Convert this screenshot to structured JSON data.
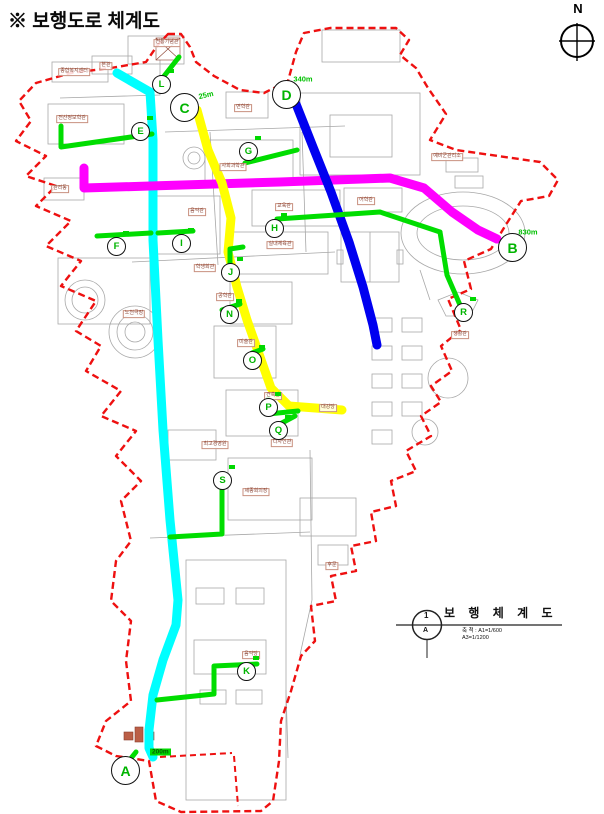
{
  "page": {
    "title": "※ 보행도로 체계도"
  },
  "compass": {
    "label": "N"
  },
  "title_block": {
    "title": "보 행 체 계 도",
    "scale_line1": "축 척 : A1=1/600",
    "scale_line2": "A3=1/1200",
    "sheet_top": "1",
    "sheet_bottom": "A"
  },
  "colors": {
    "boundary": "#ee1010",
    "route_cyan": "#00ffff",
    "route_magenta": "#ff00ff",
    "route_yellow": "#ffff00",
    "route_blue": "#0000f0",
    "route_green": "#00dd00",
    "label_green": "#00b400",
    "building_label": "#8a4434"
  },
  "endpoints": [
    {
      "id": "A",
      "x": 125,
      "y": 770,
      "distance": "200m",
      "dx": 150,
      "dy": 752,
      "boxed": true,
      "tilt": false
    },
    {
      "id": "B",
      "x": 512,
      "y": 247,
      "distance": "830m",
      "dx": 528,
      "dy": 232,
      "boxed": false,
      "tilt": false
    },
    {
      "id": "C",
      "x": 184,
      "y": 107,
      "distance": "25m",
      "dx": 206,
      "dy": 95,
      "boxed": false,
      "tilt": true
    },
    {
      "id": "D",
      "x": 286,
      "y": 94,
      "distance": "340m",
      "dx": 303,
      "dy": 79,
      "boxed": false,
      "tilt": false
    }
  ],
  "access_points": [
    {
      "id": "E",
      "x": 140,
      "y": 131
    },
    {
      "id": "F",
      "x": 116,
      "y": 246
    },
    {
      "id": "G",
      "x": 248,
      "y": 151
    },
    {
      "id": "H",
      "x": 274,
      "y": 228
    },
    {
      "id": "I",
      "x": 181,
      "y": 243
    },
    {
      "id": "J",
      "x": 230,
      "y": 272
    },
    {
      "id": "K",
      "x": 246,
      "y": 671
    },
    {
      "id": "L",
      "x": 161,
      "y": 84
    },
    {
      "id": "N",
      "x": 229,
      "y": 314
    },
    {
      "id": "O",
      "x": 252,
      "y": 360
    },
    {
      "id": "P",
      "x": 268,
      "y": 407
    },
    {
      "id": "Q",
      "x": 278,
      "y": 430
    },
    {
      "id": "R",
      "x": 463,
      "y": 312
    },
    {
      "id": "S",
      "x": 222,
      "y": 480
    }
  ],
  "buildings": [
    {
      "label": "종합복지센터",
      "x": 74,
      "y": 72
    },
    {
      "label": "본관",
      "x": 106,
      "y": 66
    },
    {
      "label": "전통기념관",
      "x": 167,
      "y": 43
    },
    {
      "label": "전산정보학관",
      "x": 72,
      "y": 119
    },
    {
      "label": "관리동",
      "x": 60,
      "y": 189
    },
    {
      "label": "면학관",
      "x": 243,
      "y": 108
    },
    {
      "label": "음악관",
      "x": 197,
      "y": 212
    },
    {
      "label": "사회과학관",
      "x": 233,
      "y": 167
    },
    {
      "label": "교육관",
      "x": 284,
      "y": 207
    },
    {
      "label": "어학관",
      "x": 366,
      "y": 201
    },
    {
      "label": "예비군관리소",
      "x": 447,
      "y": 157
    },
    {
      "label": "실내체육관",
      "x": 280,
      "y": 245
    },
    {
      "label": "학생회관",
      "x": 205,
      "y": 268
    },
    {
      "label": "공학관",
      "x": 225,
      "y": 297
    },
    {
      "label": "노천극장",
      "x": 134,
      "y": 314
    },
    {
      "label": "미술관",
      "x": 246,
      "y": 343
    },
    {
      "label": "건축관",
      "x": 273,
      "y": 396
    },
    {
      "label": "대강당",
      "x": 328,
      "y": 408
    },
    {
      "label": "디자인관",
      "x": 282,
      "y": 443
    },
    {
      "label": "최고경영원",
      "x": 215,
      "y": 445
    },
    {
      "label": "세종회의장",
      "x": 256,
      "y": 492
    },
    {
      "label": "생활관",
      "x": 460,
      "y": 335
    },
    {
      "label": "후문",
      "x": 332,
      "y": 566
    },
    {
      "label": "음악당",
      "x": 251,
      "y": 655
    }
  ]
}
